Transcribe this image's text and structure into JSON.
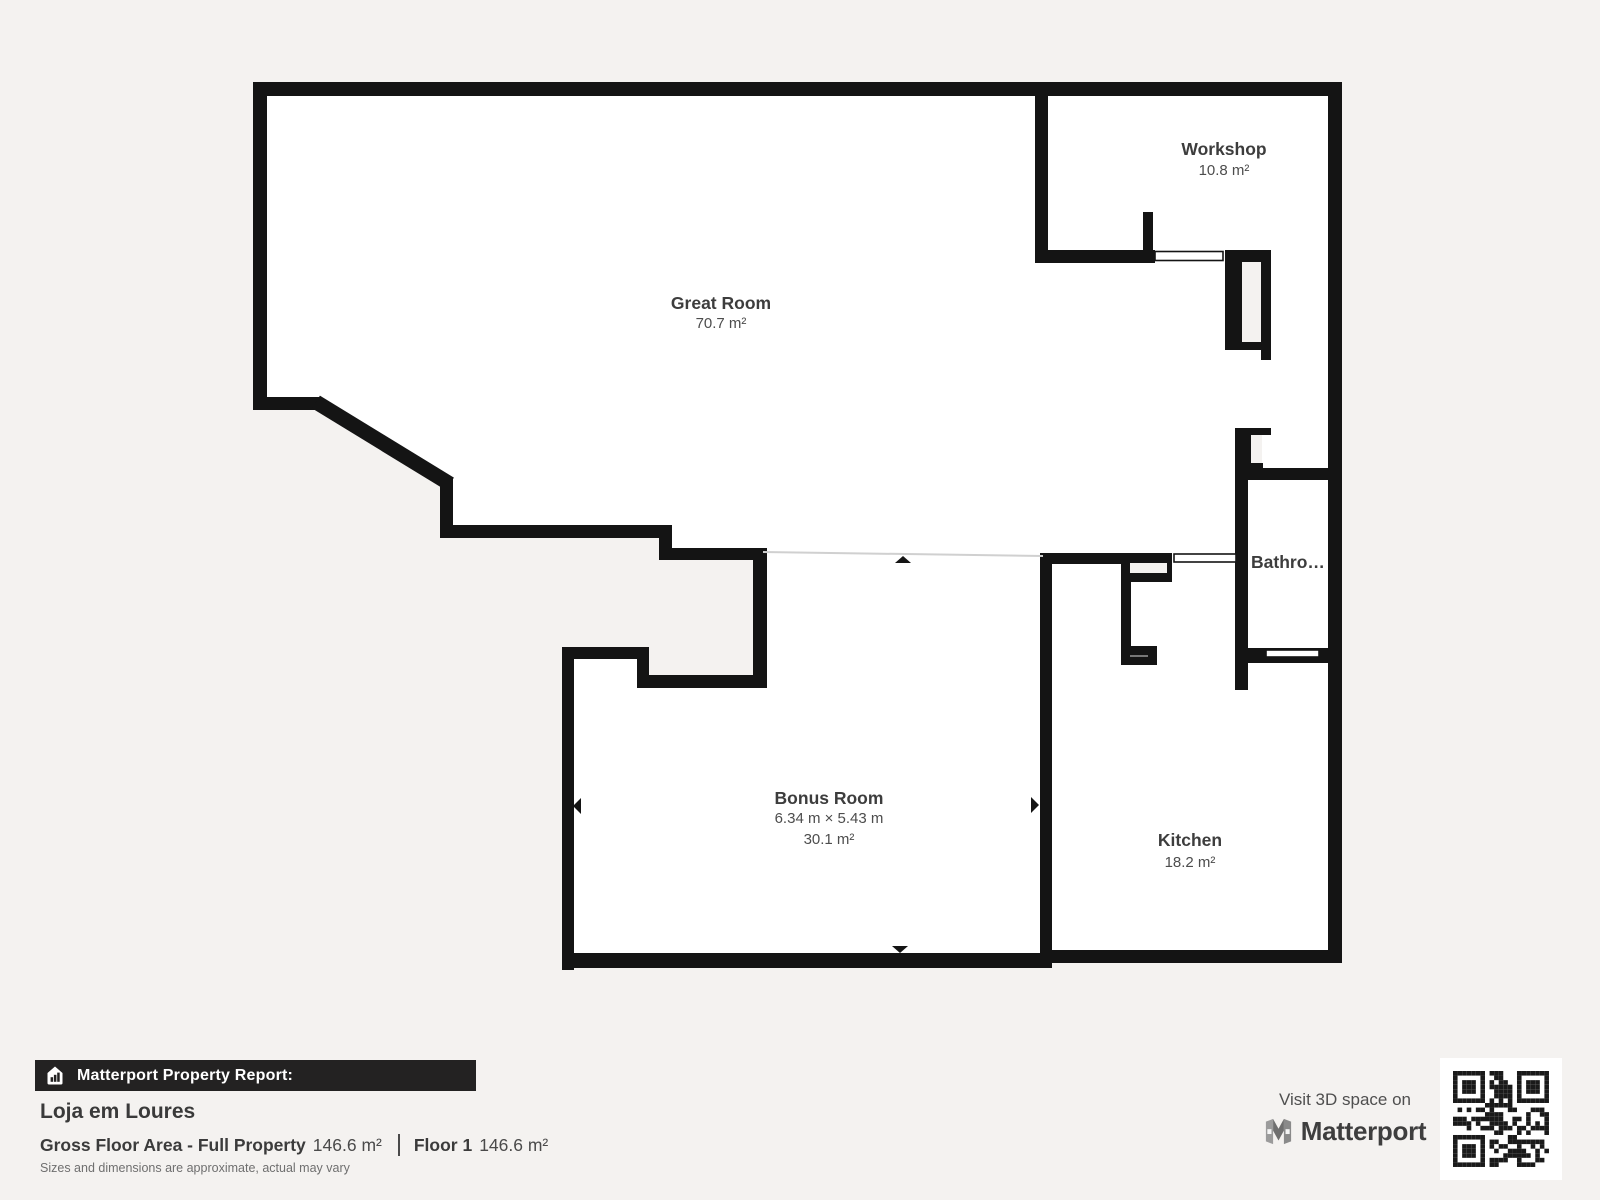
{
  "page": {
    "background": "#f4f2f0",
    "wall_color": "#141414",
    "floor_color": "#ffffff",
    "open_line_color": "#d0d0d0"
  },
  "floorplan": {
    "rooms": [
      {
        "id": "great-room",
        "name": "Great Room",
        "area": "70.7 m²"
      },
      {
        "id": "workshop",
        "name": "Workshop",
        "area": "10.8 m²"
      },
      {
        "id": "bathroom",
        "name": "Bathro…"
      },
      {
        "id": "bonus-room",
        "name": "Bonus Room",
        "dimensions": "6.34 m × 5.43 m",
        "area": "30.1 m²"
      },
      {
        "id": "kitchen",
        "name": "Kitchen",
        "area": "18.2 m²"
      }
    ]
  },
  "report": {
    "banner": "Matterport Property Report:",
    "property_name": "Loja em Loures",
    "gross_label": "Gross Floor Area - Full Property",
    "gross_value": "146.6 m²",
    "floor_label": "Floor 1",
    "floor_value": "146.6 m²",
    "disclaimer": "Sizes and dimensions are approximate, actual may vary"
  },
  "promo": {
    "visit_text": "Visit 3D space on",
    "brand": "Matterport"
  }
}
